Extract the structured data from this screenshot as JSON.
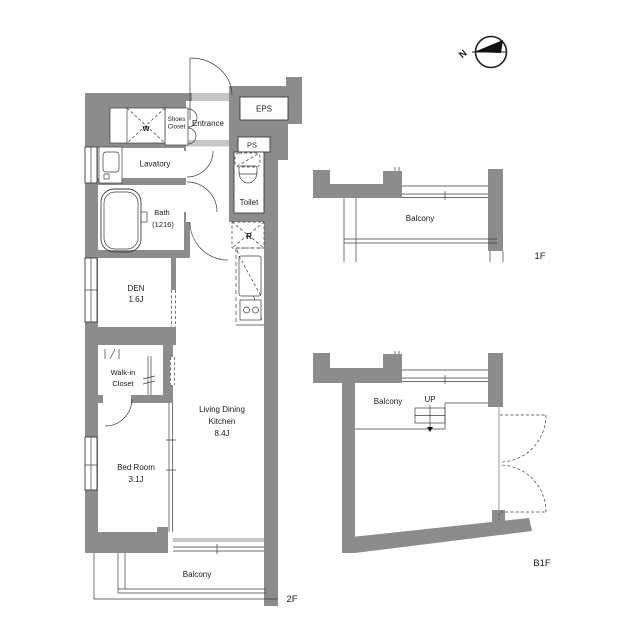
{
  "colors": {
    "wall": "#8c8c8c",
    "line": "#3c3c3c",
    "light_fill": "#c6c6c6",
    "text": "#1a1a1a"
  },
  "compass": {
    "north_label": "N"
  },
  "main_plan": {
    "floor_label": "2F",
    "labels": {
      "washer": "W",
      "shoes_closet_line1": "Shoes",
      "shoes_closet_line2": "Closet",
      "entrance": "Entrance",
      "eps": "EPS",
      "ps": "PS",
      "lavatory": "Lavatory",
      "toilet": "Toilet",
      "bath_line1": "Bath",
      "bath_line2": "(1216)",
      "refrigerator": "R",
      "den_line1": "DEN",
      "den_line2": "1.6J",
      "walkin_line1": "Walk-in",
      "walkin_line2": "Closet",
      "ldk_line1": "Living Dining",
      "ldk_line2": "Kitchen",
      "ldk_line3": "8.4J",
      "bedroom_line1": "Bed Room",
      "bedroom_line2": "3.1J",
      "balcony": "Balcony"
    }
  },
  "first_floor_plan": {
    "floor_label": "1F",
    "labels": {
      "balcony": "Balcony"
    }
  },
  "basement_plan": {
    "floor_label": "B1F",
    "labels": {
      "balcony": "Balcony",
      "up": "UP"
    }
  }
}
